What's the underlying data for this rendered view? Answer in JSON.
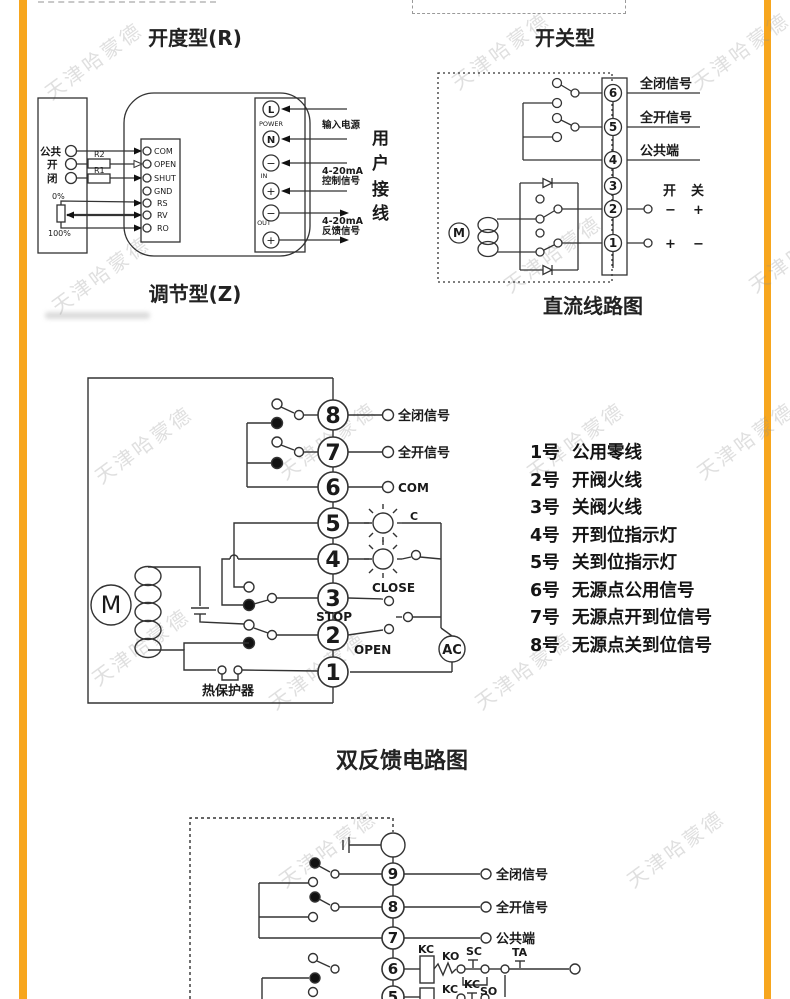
{
  "page": {
    "watermark": "天津哈蒙德",
    "accent_color": "#F7A61E"
  },
  "regulating": {
    "title": "开度型(R)",
    "caption": "调节型(Z)",
    "left_panel": {
      "terminals": [
        "公共",
        "开",
        "闭"
      ],
      "r2": "R2",
      "r1": "R1",
      "pot_top": "0%",
      "pot_bottom": "100%"
    },
    "board": {
      "terminals": [
        "COM",
        "OPEN",
        "SHUT",
        "GND",
        "RS",
        "RV",
        "RO"
      ]
    },
    "power_strip": {
      "l": "L",
      "power": "POWER",
      "n": "N",
      "minus": "−",
      "plus": "+",
      "in": "IN",
      "out": "OUT"
    },
    "notes": {
      "input_power": "输入电源",
      "ma": "4-20mA",
      "control": "控制信号",
      "feedback": "反馈信号",
      "user_wiring": [
        "用",
        "户",
        "接",
        "线"
      ]
    }
  },
  "switch_type": {
    "title": "开关型",
    "caption": "直流线路图",
    "terminals": [
      "6",
      "5",
      "4",
      "3",
      "2",
      "1"
    ],
    "labels": {
      "full_closed": "全闭信号",
      "full_open": "全开信号",
      "common": "公共端",
      "open": "开",
      "close": "关",
      "minus": "−",
      "plus": "+",
      "motor": "M"
    }
  },
  "double_feedback": {
    "title": "双反馈电路图",
    "terminals": [
      "8",
      "7",
      "6",
      "5",
      "4",
      "3",
      "2",
      "1"
    ],
    "labels": {
      "full_closed": "全闭信号",
      "full_open": "全开信号",
      "com": "COM",
      "c": "C",
      "close": "CLOSE",
      "stop": "STOP",
      "open": "OPEN",
      "ac": "AC",
      "thermal": "热保护器",
      "motor": "M"
    },
    "legend": [
      {
        "no": "1号",
        "desc": "公用零线"
      },
      {
        "no": "2号",
        "desc": "开阀火线"
      },
      {
        "no": "3号",
        "desc": "关阀火线"
      },
      {
        "no": "4号",
        "desc": "开到位指示灯"
      },
      {
        "no": "5号",
        "desc": "关到位指示灯"
      },
      {
        "no": "6号",
        "desc": "无源点公用信号"
      },
      {
        "no": "7号",
        "desc": "无源点开到位信号"
      },
      {
        "no": "8号",
        "desc": "无源点关到位信号"
      }
    ]
  },
  "ac_feedback": {
    "terminals": [
      "9",
      "8",
      "7",
      "6",
      "5"
    ],
    "labels": {
      "full_closed": "全闭信号",
      "full_open": "全开信号",
      "common": "公共端",
      "kc1": "KC",
      "ko": "KO",
      "sc": "SC",
      "ta": "TA",
      "kc2": "KC",
      "kc3": "KC",
      "so": "SO"
    }
  }
}
